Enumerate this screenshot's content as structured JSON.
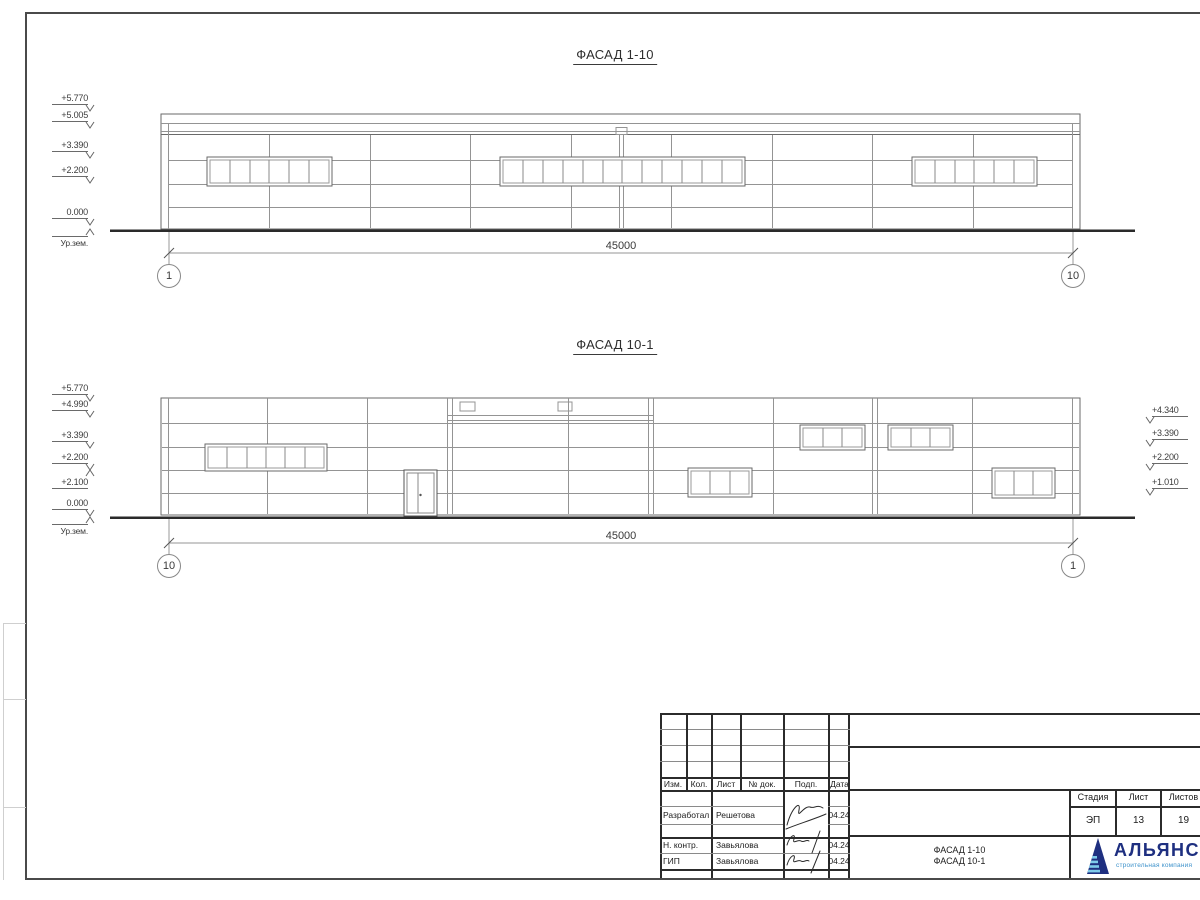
{
  "colors": {
    "logo_dark": "#1e2f80",
    "logo_light": "#7ecbea",
    "line_gray": "#949494",
    "line_dark": "#2a2a2a"
  },
  "facade1": {
    "title": "ФАСАД 1-10",
    "dimension": "45000",
    "grid_left": "1",
    "grid_right": "10",
    "marks": {
      "m5770": "+5.770",
      "m5005": "+5.005",
      "m3390": "+3.390",
      "m2200": "+2.200",
      "m0000": "0.000",
      "ground": "Ур.зем."
    }
  },
  "facade2": {
    "title": "ФАСАД 10-1",
    "dimension": "45000",
    "grid_left": "10",
    "grid_right": "1",
    "marks_left": {
      "m5770": "+5.770",
      "m4990": "+4.990",
      "m3390": "+3.390",
      "m2200": "+2.200",
      "m2100": "+2.100",
      "m0000": "0.000",
      "ground": "Ур.зем."
    },
    "marks_right": {
      "m4340": "+4.340",
      "m3390": "+3.390",
      "m2200": "+2.200",
      "m1010": "+1.010"
    }
  },
  "title_block": {
    "rev_header": {
      "izm": "Изм.",
      "kol": "Кол.",
      "list": "Лист",
      "ndok": "№ док.",
      "podp": "Подп.",
      "data": "Дата"
    },
    "rows": [
      {
        "role": "Разработал",
        "name": "Решетова",
        "date": "04.24"
      },
      {
        "role": "Н. контр.",
        "name": "Завьялова",
        "date": "04.24"
      },
      {
        "role": "ГИП",
        "name": "Завьялова",
        "date": "04.24"
      }
    ],
    "stage": {
      "h1": "Стадия",
      "h2": "Лист",
      "h3": "Листов",
      "v1": "ЭП",
      "v2": "13",
      "v3": "19"
    },
    "doc_title_1": "ФАСАД 1-10",
    "doc_title_2": "ФАСАД 10-1",
    "company": "АЛЬЯНС",
    "company_sub": "строительная компания"
  }
}
